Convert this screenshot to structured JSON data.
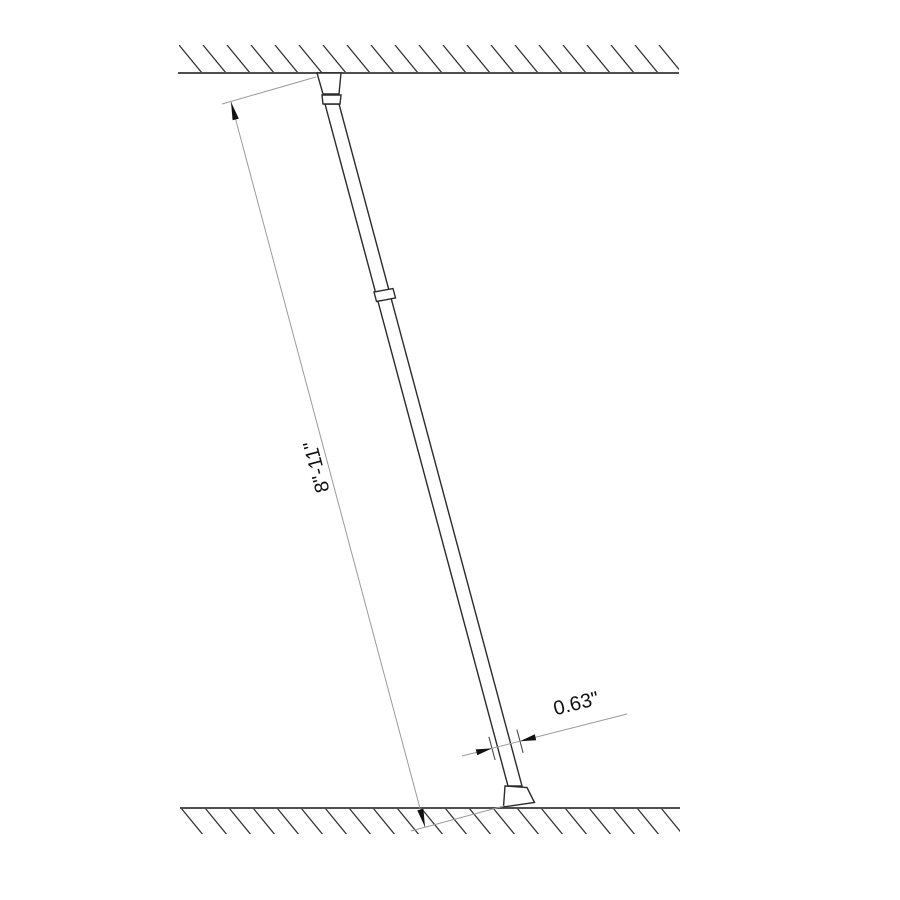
{
  "drawing": {
    "labels": {
      "height_dimension": "8\"-11\"",
      "diameter_dimension": "0.63\""
    },
    "colors": {
      "background": "#ffffff",
      "object_line": "#2b2b2b",
      "surface_line": "#4f4f4f",
      "hatch_line": "#333333",
      "dimension_line": "#9b9b9b",
      "extension_tick": "#4a4a4a",
      "arrowhead_and_text": "#111111"
    }
  }
}
